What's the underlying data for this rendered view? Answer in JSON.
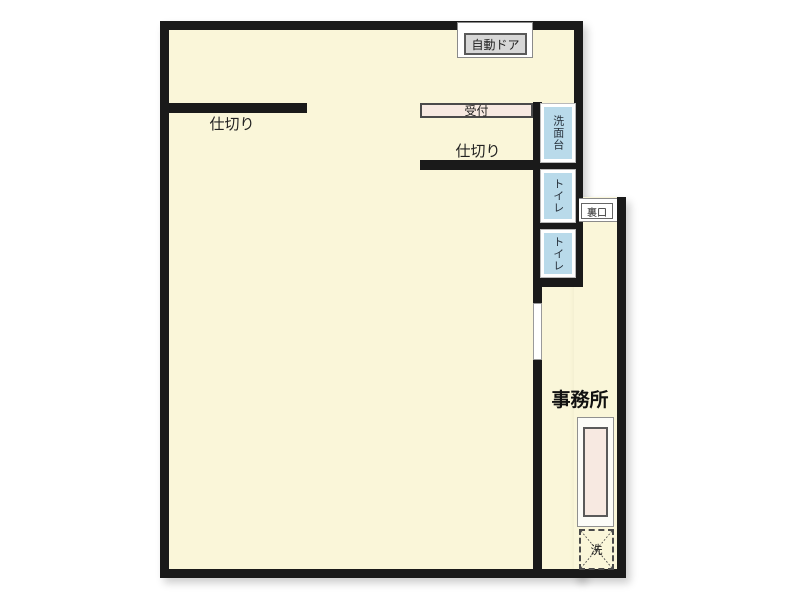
{
  "floorplan": {
    "title": "店舗・事務所 間取り図",
    "labels": {
      "auto_door": "自動ドア",
      "partition1": "仕切り",
      "partition2": "仕切り",
      "reception": "受付",
      "washstand": "洗面台",
      "toilet1": "トイレ",
      "toilet2": "トイレ",
      "back_door": "裏口",
      "office": "事務所",
      "washing_machine": "洗"
    },
    "colors": {
      "wall": "#1a1a1a",
      "floor": "#faf6d9",
      "fixture_blue": "#b9daea",
      "fixture_pink": "#f7e9e1",
      "door_label_gray": "#d7d7d7",
      "background": "#ffffff"
    }
  }
}
